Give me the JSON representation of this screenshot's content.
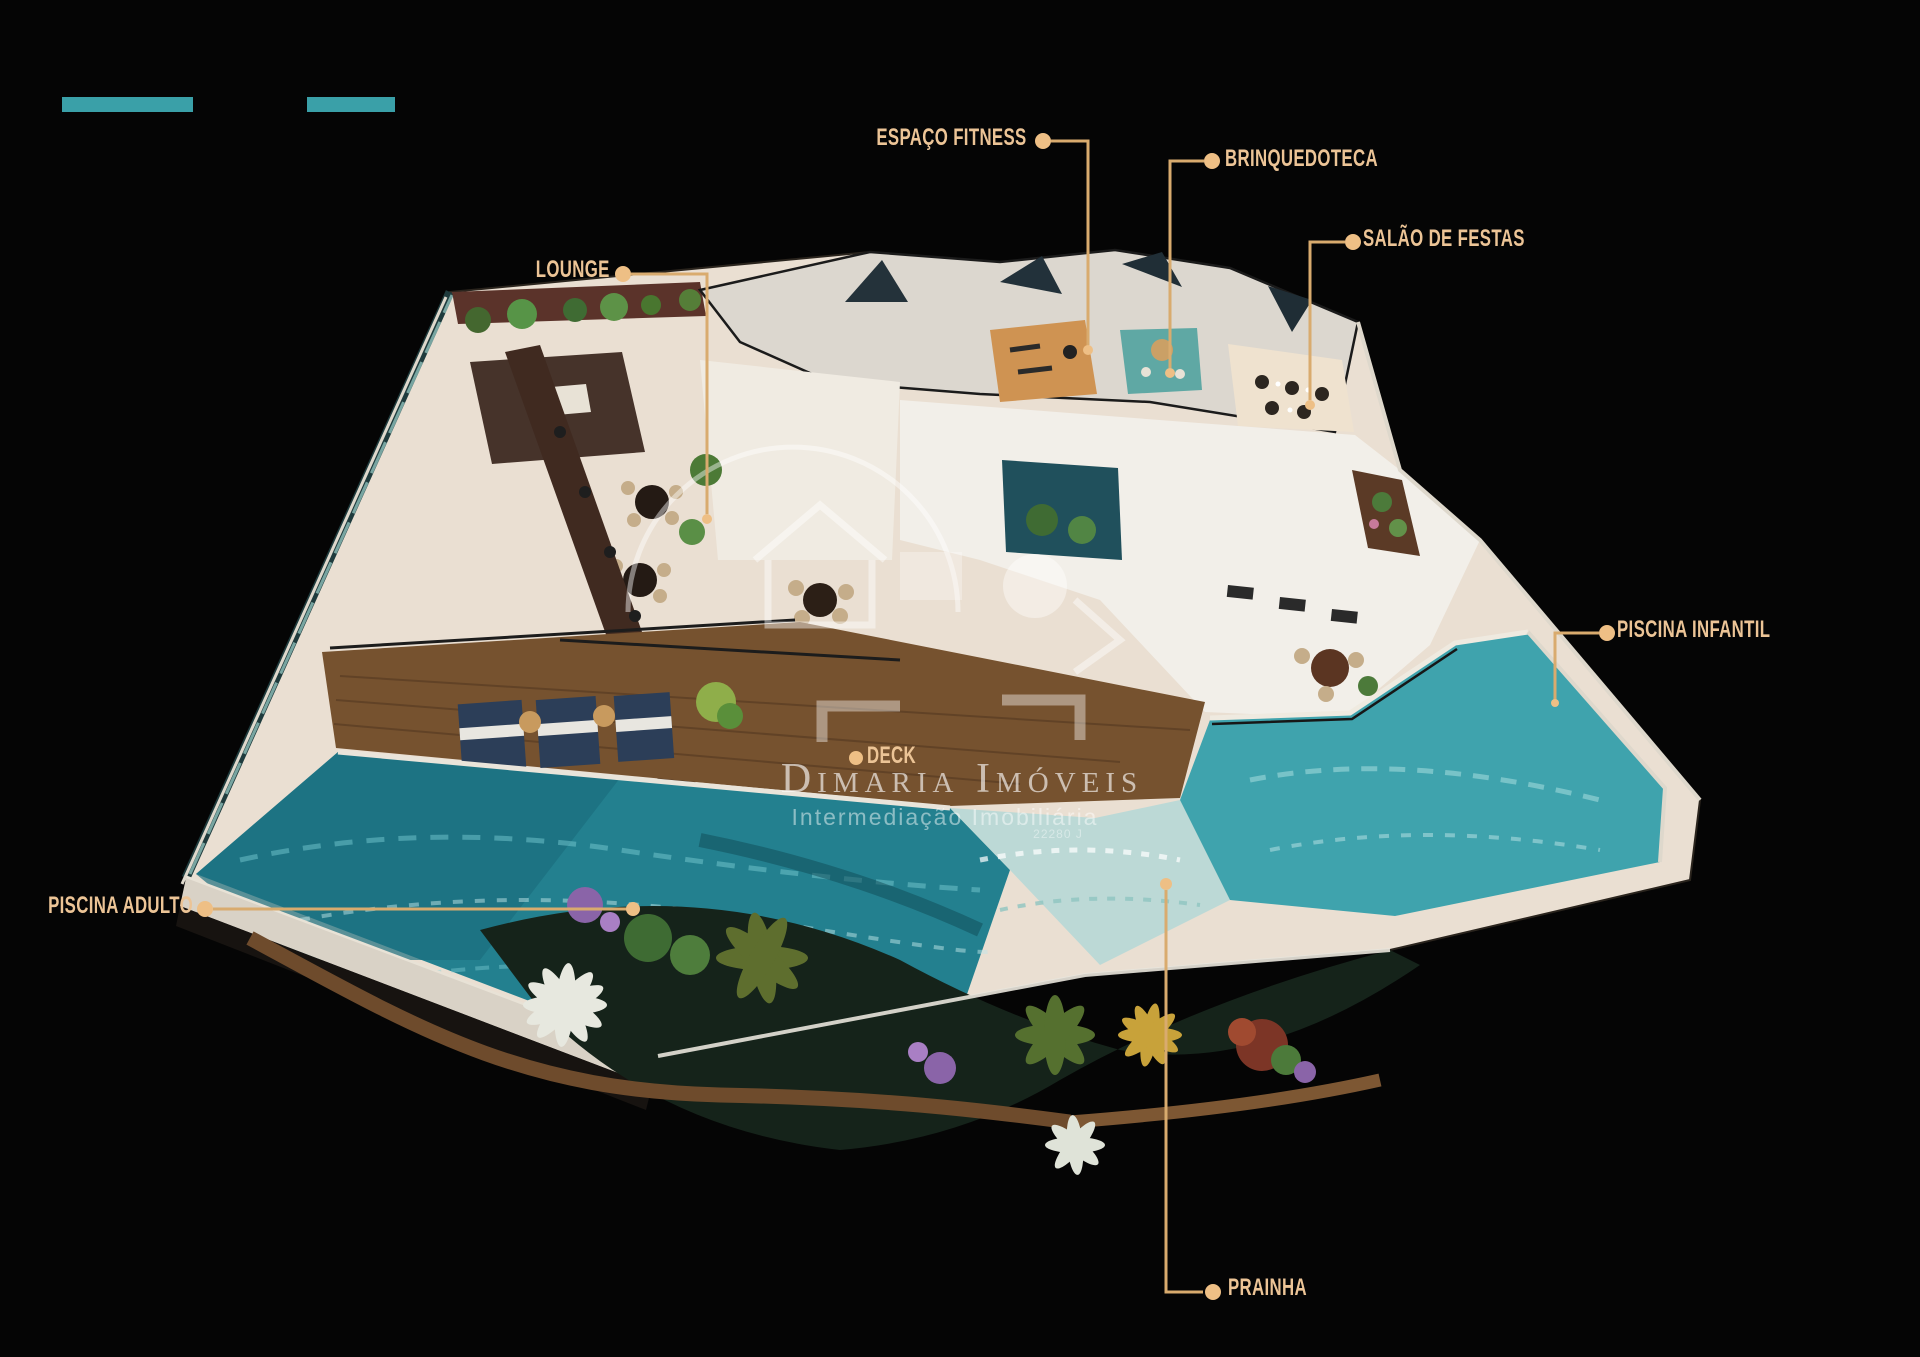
{
  "annotations": {
    "espaco_fitness": {
      "label": "ESPAÇO FITNESS"
    },
    "brinquedoteca": {
      "label": "BRINQUEDOTECA"
    },
    "salao_de_festas": {
      "label": "SALÃO DE FESTAS"
    },
    "lounge": {
      "label": "LOUNGE"
    },
    "piscina_infantil": {
      "label": "PISCINA INFANTIL"
    },
    "piscina_adulto": {
      "label": "PISCINA ADULTO"
    },
    "deck": {
      "label": "DECK"
    },
    "prainha": {
      "label": "PRAINHA"
    }
  },
  "watermark": {
    "name": "Dimaria Imóveis",
    "tagline": "Intermediação Imobiliária",
    "registration": "22280 J"
  },
  "colors": {
    "background": "#050505",
    "brand_bar_teal": "#3aa0a8",
    "label_gold": "#ecc496",
    "leader_line_gold": "#d9ab6e",
    "adult_pool_water": "#23808f",
    "kids_pool_water": "#3fa3ad",
    "deck_wood": "#76522f",
    "stone_floor": "#eadfd2"
  }
}
